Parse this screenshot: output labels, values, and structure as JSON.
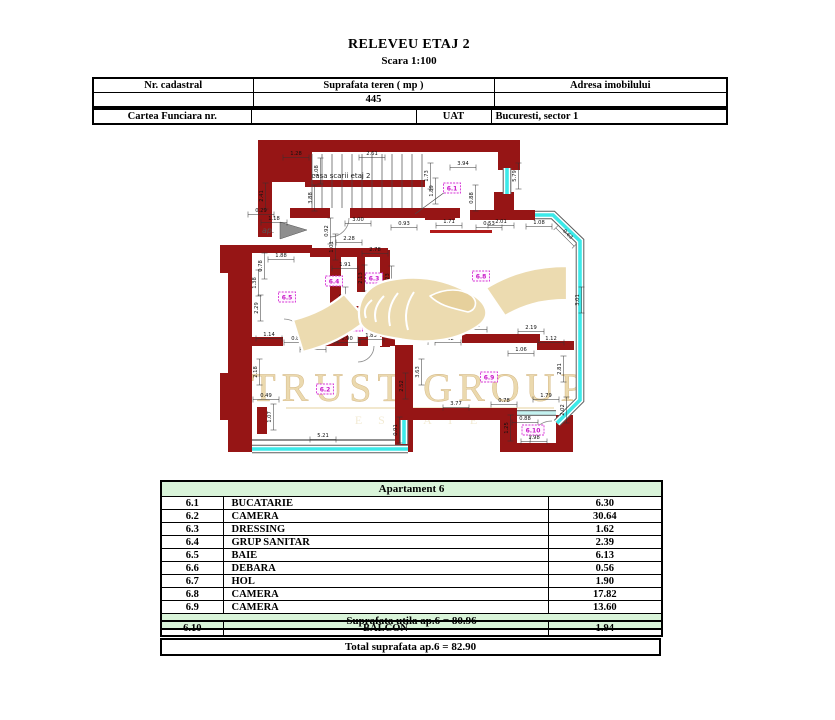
{
  "page": {
    "title": "RELEVEU ETAJ 2",
    "subtitle": "Scara 1:100"
  },
  "info_table": {
    "headers": [
      "Nr. cadastral",
      "Suprafata teren ( mp )",
      "Adresa imobilului"
    ],
    "values": [
      "",
      "445",
      ""
    ]
  },
  "cf_table": {
    "label": "Cartea Funciara nr.",
    "cf_value": "",
    "uat_label": "UAT",
    "uat_value": "Bucuresti, sector 1"
  },
  "plan": {
    "stair_label": "casa scarii etaj 2",
    "entrance_label": "ap.",
    "watermark": {
      "line1": "TRUST GROUP",
      "line2": "ESTATE"
    },
    "colors": {
      "wall": "#961515",
      "window": "#3ce9e9",
      "label": "#d633d6",
      "watermark": "#e8d3a0",
      "green": "#d9f4d9"
    },
    "room_labels": [
      [
        "6.1",
        452,
        188
      ],
      [
        "6.2",
        325,
        389
      ],
      [
        "6.3",
        374,
        278
      ],
      [
        "6.4",
        334,
        281
      ],
      [
        "6.5",
        287,
        297
      ],
      [
        "6.6",
        327,
        326
      ],
      [
        "6.7",
        354,
        326
      ],
      [
        "6.8",
        481,
        276
      ],
      [
        "6.9",
        489,
        377
      ],
      [
        "6.10",
        533,
        430
      ]
    ],
    "dimensions": [
      [
        "1.28",
        296,
        156,
        0
      ],
      [
        "2.61",
        372,
        156,
        0
      ],
      [
        "1.08",
        319,
        171,
        -90
      ],
      [
        "2.41",
        264,
        196,
        -90
      ],
      [
        "3.88",
        313,
        198,
        -90
      ],
      [
        "1.73",
        429,
        176,
        -90
      ],
      [
        "3.94",
        463,
        166,
        0
      ],
      [
        "1.89",
        434,
        191,
        -90
      ],
      [
        "5.79",
        517,
        176,
        -90
      ],
      [
        "0.29",
        261,
        213,
        0
      ],
      [
        "1.18",
        274,
        221,
        0
      ],
      [
        "3.00",
        358,
        222,
        0
      ],
      [
        "0.93",
        404,
        226,
        0
      ],
      [
        "0.92",
        329,
        231,
        -90
      ],
      [
        "1.01",
        334,
        247,
        -90
      ],
      [
        "2.28",
        349,
        241,
        0
      ],
      [
        "0.88",
        474,
        198,
        -90
      ],
      [
        "0.53",
        489,
        226,
        0
      ],
      [
        "1.71",
        449,
        224,
        0
      ],
      [
        "2.01",
        501,
        224,
        0
      ],
      [
        "1.08",
        539,
        225,
        0
      ],
      [
        "0.63",
        566,
        236,
        45
      ],
      [
        "3.01",
        580,
        300,
        -90
      ],
      [
        "1.88",
        281,
        258,
        0
      ],
      [
        "0.78",
        263,
        266,
        -90
      ],
      [
        "1.38",
        257,
        283,
        -90
      ],
      [
        "2.29",
        259,
        308,
        -90
      ],
      [
        "1.14",
        269,
        337,
        0
      ],
      [
        "0.80",
        297,
        341,
        0
      ],
      [
        "1.03",
        313,
        348,
        0
      ],
      [
        "0.88",
        325,
        340,
        0
      ],
      [
        "0.90",
        347,
        341,
        0
      ],
      [
        "1.83",
        371,
        338,
        0
      ],
      [
        "1.91",
        345,
        267,
        0
      ],
      [
        "2.78",
        375,
        252,
        0
      ],
      [
        "2.13",
        363,
        278,
        -90
      ],
      [
        "2.23",
        390,
        279,
        -90
      ],
      [
        "1.98",
        344,
        300,
        -90
      ],
      [
        "2.18",
        258,
        372,
        -90
      ],
      [
        "0.49",
        266,
        398,
        0
      ],
      [
        "1.07",
        272,
        417,
        -90
      ],
      [
        "5.21",
        323,
        438,
        0
      ],
      [
        "0.91",
        398,
        430,
        -90
      ],
      [
        "3.63",
        420,
        372,
        -90
      ],
      [
        "2.52",
        404,
        386,
        -90
      ],
      [
        "3.77",
        456,
        406,
        0
      ],
      [
        "0.78",
        504,
        403,
        0
      ],
      [
        "3.22",
        448,
        341,
        0
      ],
      [
        "1.01",
        474,
        328,
        0
      ],
      [
        "2.19",
        531,
        330,
        0
      ],
      [
        "1.12",
        551,
        341,
        0
      ],
      [
        "1.06",
        521,
        352,
        0
      ],
      [
        "2.81",
        562,
        369,
        -90
      ],
      [
        "1.79",
        546,
        398,
        0
      ],
      [
        "2.02",
        565,
        410,
        -90
      ],
      [
        "0.88",
        525,
        421,
        0
      ],
      [
        "1.98",
        534,
        440,
        0
      ],
      [
        "1.25",
        509,
        428,
        -90
      ]
    ]
  },
  "area_table": {
    "title": "Apartament 6",
    "rows": [
      {
        "no": "6.1",
        "name": "BUCATARIE",
        "area": "6.30"
      },
      {
        "no": "6.2",
        "name": "CAMERA",
        "area": "30.64"
      },
      {
        "no": "6.3",
        "name": "DRESSING",
        "area": "1.62"
      },
      {
        "no": "6.4",
        "name": "GRUP SANITAR",
        "area": "2.39"
      },
      {
        "no": "6.5",
        "name": "BAIE",
        "area": "6.13"
      },
      {
        "no": "6.6",
        "name": "DEBARA",
        "area": "0.56"
      },
      {
        "no": "6.7",
        "name": "HOL",
        "area": "1.90"
      },
      {
        "no": "6.8",
        "name": "CAMERA",
        "area": "17.82"
      },
      {
        "no": "6.9",
        "name": "CAMERA",
        "area": "13.60"
      }
    ],
    "subtotal": "Suprafata utila ap.6 = 80.96",
    "balcony": {
      "no": "6.10",
      "name": "BALCON",
      "area": "1.94"
    },
    "total": "Total suprafata ap.6 = 82.90"
  }
}
